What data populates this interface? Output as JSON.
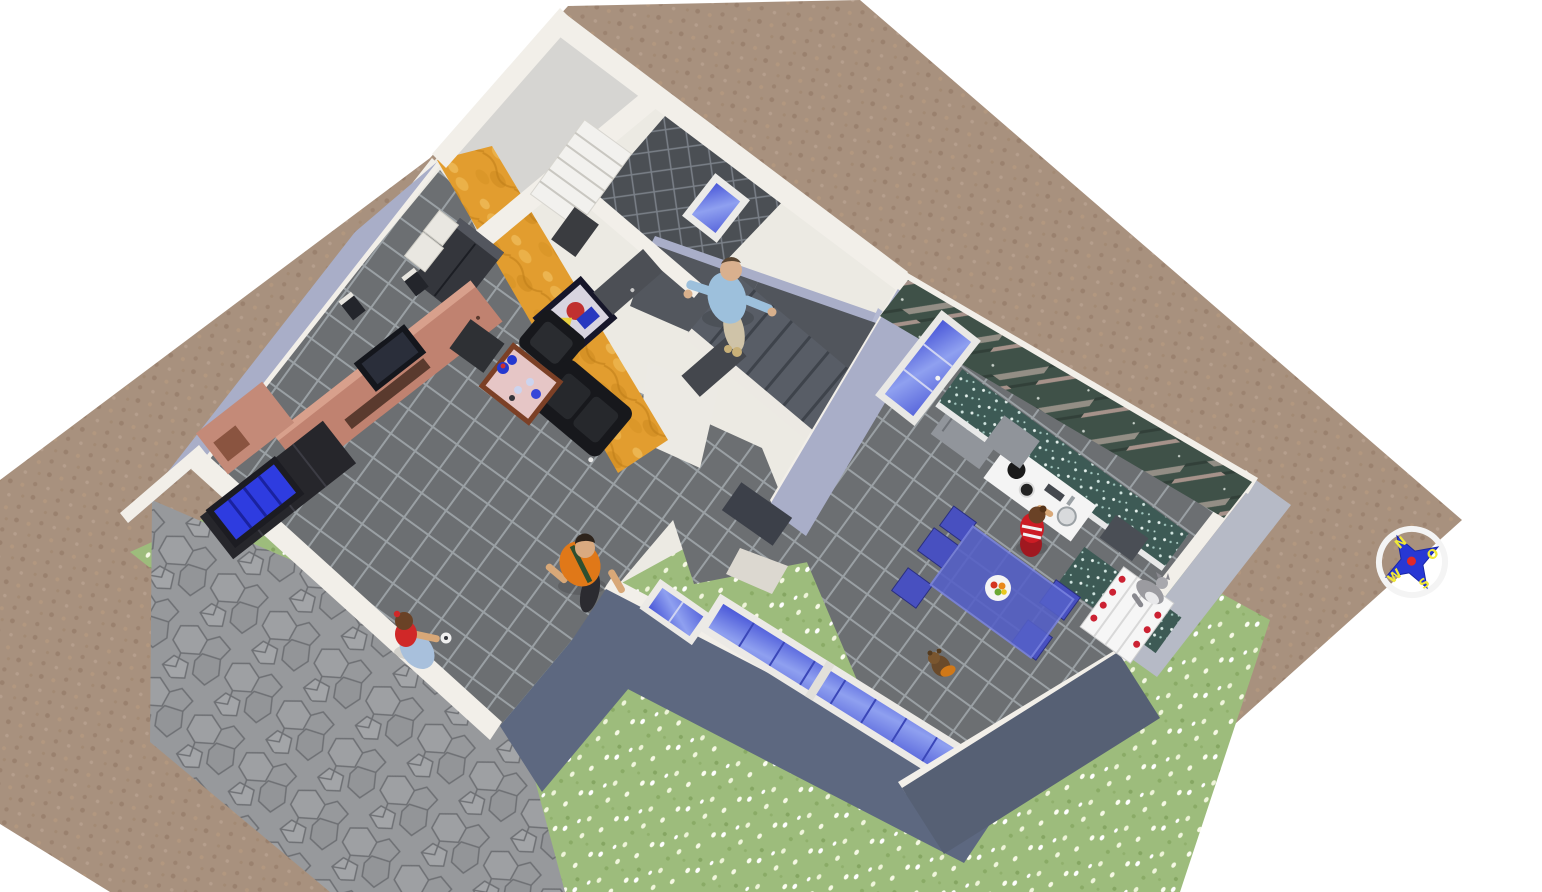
{
  "app": {
    "view_title": "aerial-3d-home-view",
    "description": "3D aerial rendering of a single-storey house interior with garden"
  },
  "compass": {
    "north": "N",
    "south": "S",
    "west": "W",
    "east": "O"
  },
  "palette": {
    "canvas": "#ffffff",
    "dirt": "#a8917e",
    "grass": "#9dbc7c",
    "flagstone": "#97999c",
    "floor_tile": "#6c6f72",
    "bath_tile": "#4b4f54",
    "wall_cap": "#f2efe9",
    "wall_lavender": "#a9aec8",
    "wall_dark_blue": "#5d6880",
    "orange_wall": "#e29d2f",
    "marble_green": "#3f5148",
    "counter_speckle": "#3d5a55",
    "dining_blue": "#5560c8",
    "glass_blue": "#6a76e8",
    "sofa_black": "#17181c",
    "sideboard_wood": "#c08270",
    "stairs_gray": "#585d66",
    "compass_star": "#2838d4",
    "compass_letter": "#f0e838",
    "compass_center": "#e02828"
  },
  "scene": {
    "rooms": [
      {
        "name": "living-room"
      },
      {
        "name": "kitchen"
      },
      {
        "name": "bathroom"
      },
      {
        "name": "storage-room"
      },
      {
        "name": "entry-hall"
      },
      {
        "name": "stairwell"
      },
      {
        "name": "courtyard-garden"
      }
    ],
    "furniture": [
      {
        "name": "sideboard-tv-unit"
      },
      {
        "name": "television"
      },
      {
        "name": "speakers"
      },
      {
        "name": "bookcase-blue-glass"
      },
      {
        "name": "wardrobe"
      },
      {
        "name": "armchair"
      },
      {
        "name": "sofa"
      },
      {
        "name": "coffee-table"
      },
      {
        "name": "painting"
      },
      {
        "name": "shelf-unit"
      },
      {
        "name": "refrigerator"
      },
      {
        "name": "kitchen-counter"
      },
      {
        "name": "stove"
      },
      {
        "name": "sink"
      },
      {
        "name": "radiator"
      },
      {
        "name": "dining-table"
      },
      {
        "name": "dining-chairs"
      },
      {
        "name": "fruit-plate"
      },
      {
        "name": "staircase"
      }
    ],
    "people": [
      {
        "name": "man-on-stairs",
        "clothing": "light blue shirt, beige trousers"
      },
      {
        "name": "man-orange-shirt",
        "clothing": "orange shirt, black trousers"
      },
      {
        "name": "woman-blue-skirt",
        "clothing": "red top, light blue skirt, holding cup"
      },
      {
        "name": "woman-cooking",
        "clothing": "red striped top at stove"
      }
    ],
    "animals": [
      {
        "name": "teddy-bear"
      },
      {
        "name": "cat"
      }
    ]
  }
}
